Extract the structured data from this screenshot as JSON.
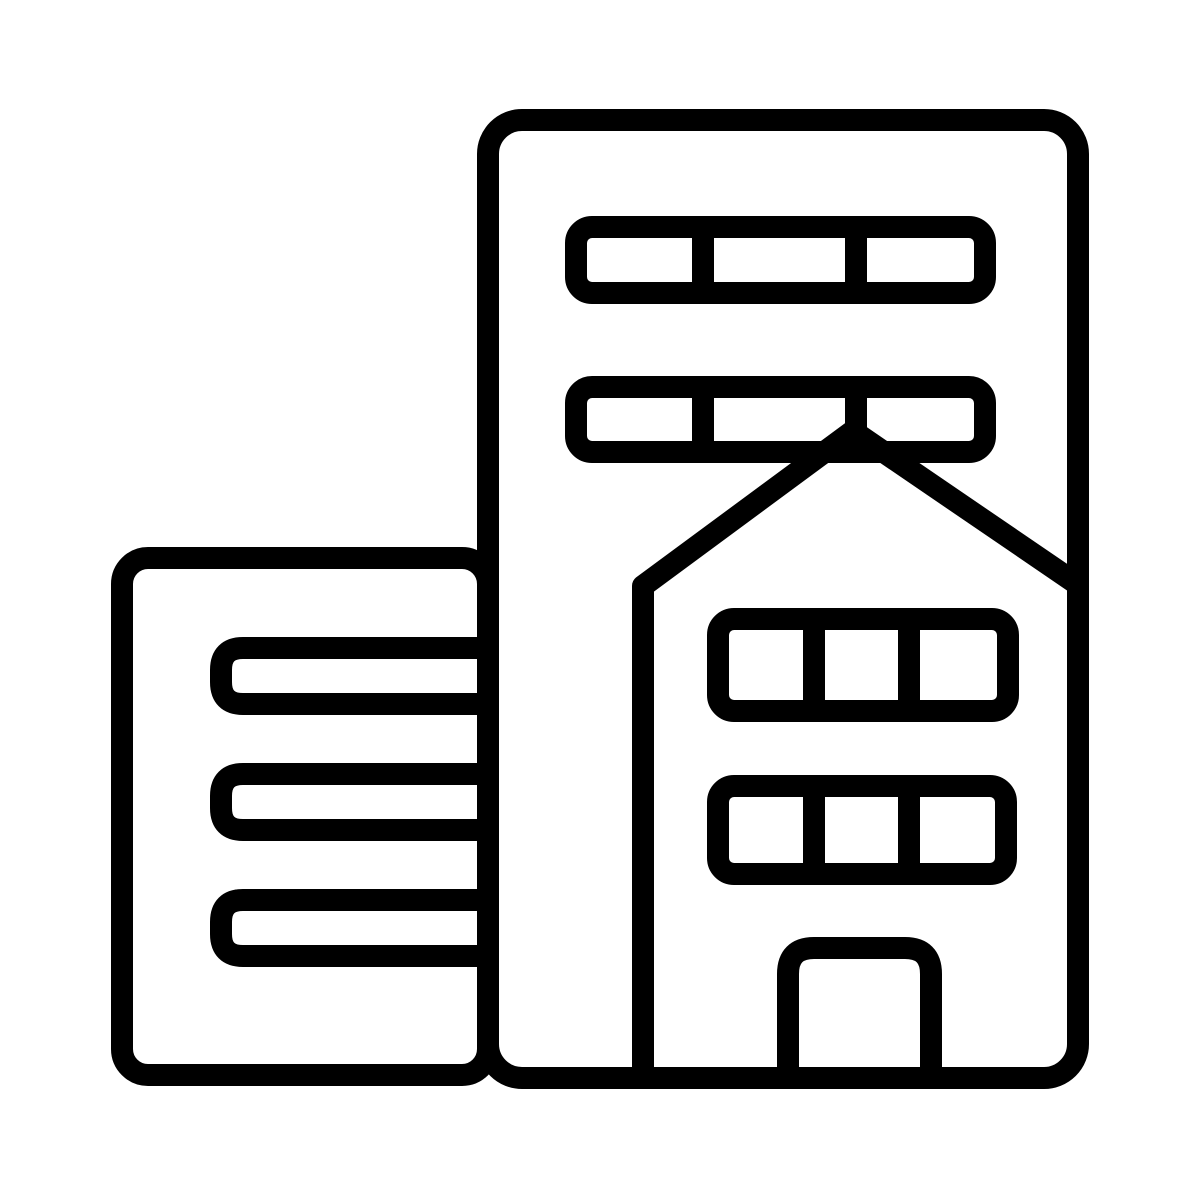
{
  "meta": {
    "background_color": "#ffffff"
  },
  "icon": {
    "name": "office-buildings-icon",
    "description": "Black outline icon of city buildings: a tall tower with two three-pane window strips, a pitched-roof house in front with two three-pane window strips and a door, and a shorter side building with three horizontal window bars",
    "stroke_color": "#000000"
  }
}
